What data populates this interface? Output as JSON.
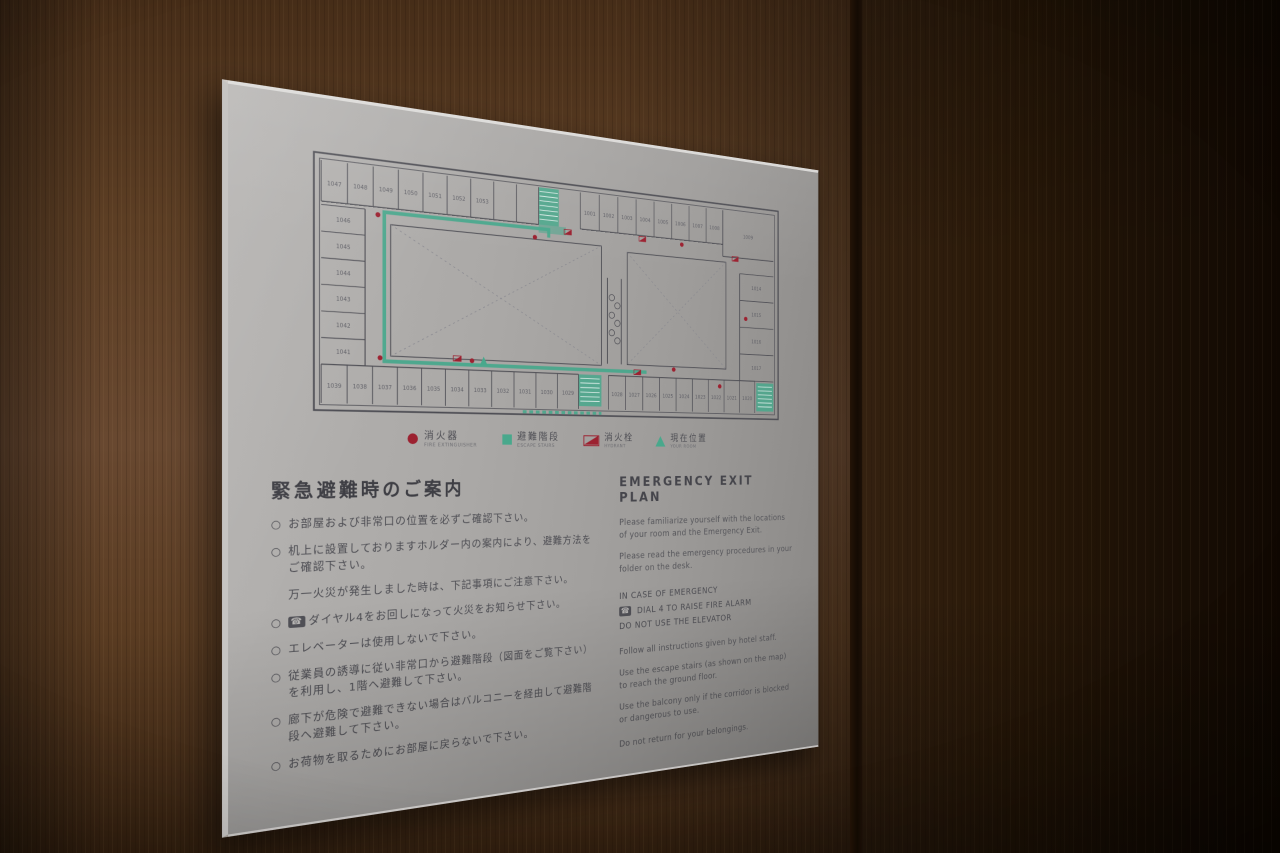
{
  "colors": {
    "red": "#9c2130",
    "teal": "#49a88c",
    "plan_line": "#4b4b52",
    "text": "#4a4a50"
  },
  "sign": {
    "phone_icon": "☎",
    "floor_plan": {
      "rooms": {
        "top_left": [
          "1047",
          "1048",
          "1049",
          "1050",
          "1051",
          "1052",
          "1053"
        ],
        "top_right": [
          "1001",
          "1002",
          "1003",
          "1004",
          "1005",
          "1006",
          "1007",
          "1008"
        ],
        "top_right_corner": "1009",
        "left_column": [
          "1046",
          "1045",
          "1044",
          "1043",
          "1042",
          "1041"
        ],
        "right_column": [
          "1014",
          "1015",
          "1016",
          "1017"
        ],
        "bottom_left": [
          "1039",
          "1038",
          "1037",
          "1036",
          "1035",
          "1034",
          "1033",
          "1032",
          "1031",
          "1030",
          "1029"
        ],
        "bottom_right": [
          "1028",
          "1027",
          "1026",
          "1025",
          "1024",
          "1023",
          "1022",
          "1021",
          "1020"
        ]
      },
      "legend": [
        {
          "jp": "消火器",
          "en": "FIRE EXTINGUISHER"
        },
        {
          "jp": "避難階段",
          "en": "ESCAPE STAIRS"
        },
        {
          "jp": "消火栓",
          "en": "HYDRANT"
        },
        {
          "jp": "現在位置",
          "en": "YOUR ROOM"
        }
      ]
    },
    "jp": {
      "heading": "緊急避難時のご案内",
      "marker": "○",
      "items": [
        "お部屋および非常口の位置を必ずご確認下さい。",
        "机上に設置しておりますホルダー内の案内により、避難方法をご確認下さい。",
        "ダイヤル4をお回しになって火災をお知らせ下さい。",
        "エレベーターは使用しないで下さい。",
        "従業員の誘導に従い非常口から避難階段（図面をご覧下さい）を利用し、1階へ避難して下さい。",
        "廊下が危険で避難できない場合はバルコニーを経由して避難階段へ避難して下さい。",
        "お荷物を取るためにお部屋に戻らないで下さい。"
      ],
      "note": "万一火災が発生しました時は、下記事項にご注意下さい。"
    },
    "en": {
      "heading": "EMERGENCY EXIT PLAN",
      "p1": "Please familiarize yourself with the locations of your room and the Emergency Exit.",
      "p2": "Please read the emergency procedures in your folder on the desk.",
      "emergency": [
        "IN CASE OF EMERGENCY",
        "DIAL 4 TO RAISE FIRE ALARM",
        "DO NOT USE THE ELEVATOR"
      ],
      "p3": "Follow all instructions given by hotel staff.",
      "p4": "Use the escape stairs (as shown on the map) to reach the ground floor.",
      "p5": "Use the balcony only if the corridor is blocked or dangerous to use.",
      "p6": "Do not return for your belongings."
    }
  }
}
